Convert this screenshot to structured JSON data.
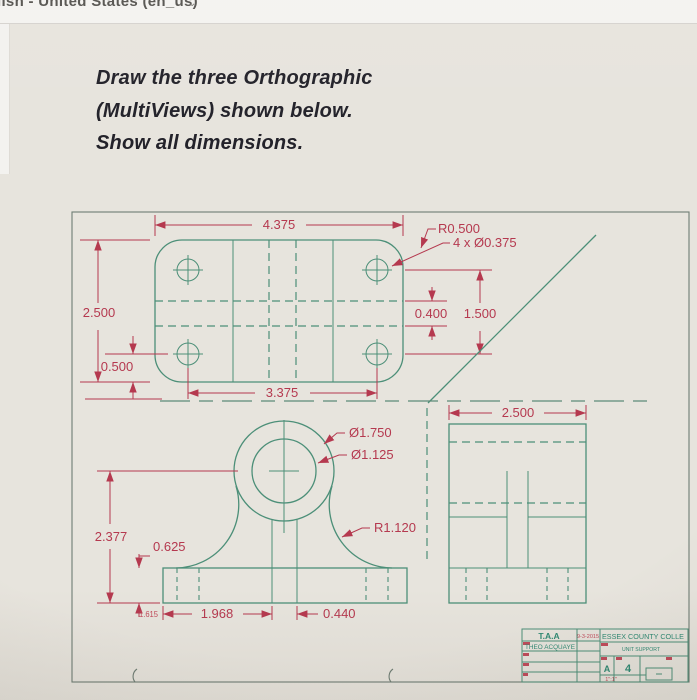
{
  "browser_bar": {
    "language_text": "lish - United States (en_us)",
    "caret": "⌄"
  },
  "instructions": {
    "line1": "Draw the three Orthographic",
    "line2": "(MultiViews) shown below.",
    "line3": "Show all dimensions."
  },
  "drawing": {
    "top_view": {
      "width": "4.375",
      "height": "2.500",
      "hole_edge_offset": "0.500",
      "hole_spacing": "3.375",
      "corner_radius": "R0.500",
      "hole_callout": "4 x Ø0.375",
      "web_width": "0.400",
      "hole_row_spacing": "1.500"
    },
    "front_view": {
      "boss_outer_dia": "Ø1.750",
      "boss_inner_dia": "Ø1.125",
      "fillet_radius": "R1.120",
      "height": "2.377",
      "base_thickness": "0.625",
      "left_span": "1.968",
      "web_width": "0.440",
      "small_dim": "1.615"
    },
    "side_view": {
      "depth": "2.500"
    }
  },
  "title_block": {
    "initials": "T.A.A",
    "date": "9-3-2015",
    "author": "THEO ACQUAYE",
    "institution": "ESSEX COUNTY COLLE",
    "drawing_title": "UNIT SUPPORT",
    "sheet_size": "A",
    "sheet_number": "4",
    "scale": "1\":1\""
  },
  "colors": {
    "drawing_line": "#4c8f78",
    "dimension": "#b5394f",
    "sheet_border": "#6e7d74",
    "heading_text": "#23222a",
    "background": "#e7e4dd"
  }
}
